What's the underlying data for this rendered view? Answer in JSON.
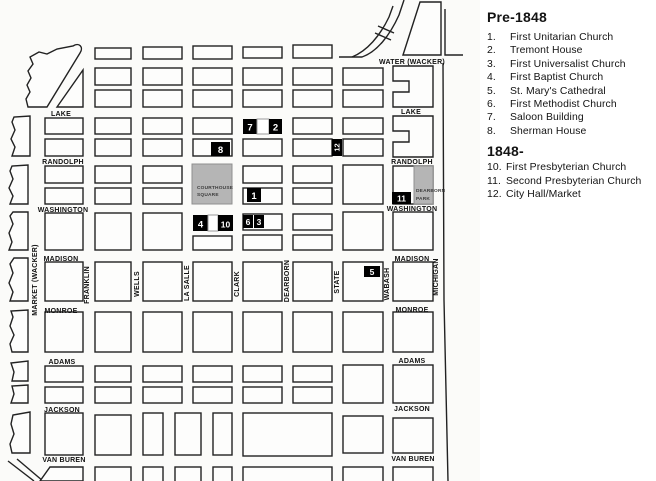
{
  "legend": {
    "pre_title": "Pre-1848",
    "post_title": "1848-",
    "pre_items": [
      {
        "num": "1.",
        "label": "First Unitarian Church"
      },
      {
        "num": "2.",
        "label": "Tremont House"
      },
      {
        "num": "3.",
        "label": "First Universalist Church"
      },
      {
        "num": "4.",
        "label": "First Baptist Church"
      },
      {
        "num": "5.",
        "label": "St. Mary's Cathedral"
      },
      {
        "num": "6.",
        "label": "First Methodist Church"
      },
      {
        "num": "7.",
        "label": "Saloon Building"
      },
      {
        "num": "8.",
        "label": "Sherman House"
      }
    ],
    "post_items": [
      {
        "num": "10.",
        "label": "First Presbyterian Church"
      },
      {
        "num": "11.",
        "label": "Second Presbyterian Church"
      },
      {
        "num": "12.",
        "label": "City Hall/Market"
      }
    ]
  },
  "map": {
    "left_streets": [
      "LAKE",
      "RANDOLPH",
      "WASHINGTON",
      "MADISON",
      "MONROE",
      "ADAMS",
      "JACKSON",
      "VAN BUREN"
    ],
    "right_streets": [
      "WATER (WACKER)",
      "LAKE",
      "RANDOLPH",
      "WASHINGTON",
      "MADISON",
      "MONROE",
      "ADAMS",
      "JACKSON",
      "VAN BUREN"
    ],
    "vertical_streets": [
      "MARKET (WACKER)",
      "FRANKLIN",
      "WELLS",
      "LA SALLE",
      "CLARK",
      "DEARBORN",
      "STATE",
      "WABASH",
      "MICHIGAN"
    ],
    "areas": {
      "courthouse_line1": "COURTHOUSE",
      "courthouse_line2": "SQUARE",
      "dearborn_park_line1": "DEARBORN",
      "dearborn_park_line2": "PARK"
    },
    "markers": {
      "n1": "1",
      "n2": "2",
      "n3": "3",
      "n4": "4",
      "n5": "5",
      "n6": "6",
      "n7": "7",
      "n8": "8",
      "n10": "10",
      "n11": "11",
      "n12": "12"
    }
  },
  "colors": {
    "park_gray": "#b5b5b5",
    "marker_black": "#000000",
    "marker_text": "#ffffff",
    "line_black": "#222222"
  }
}
